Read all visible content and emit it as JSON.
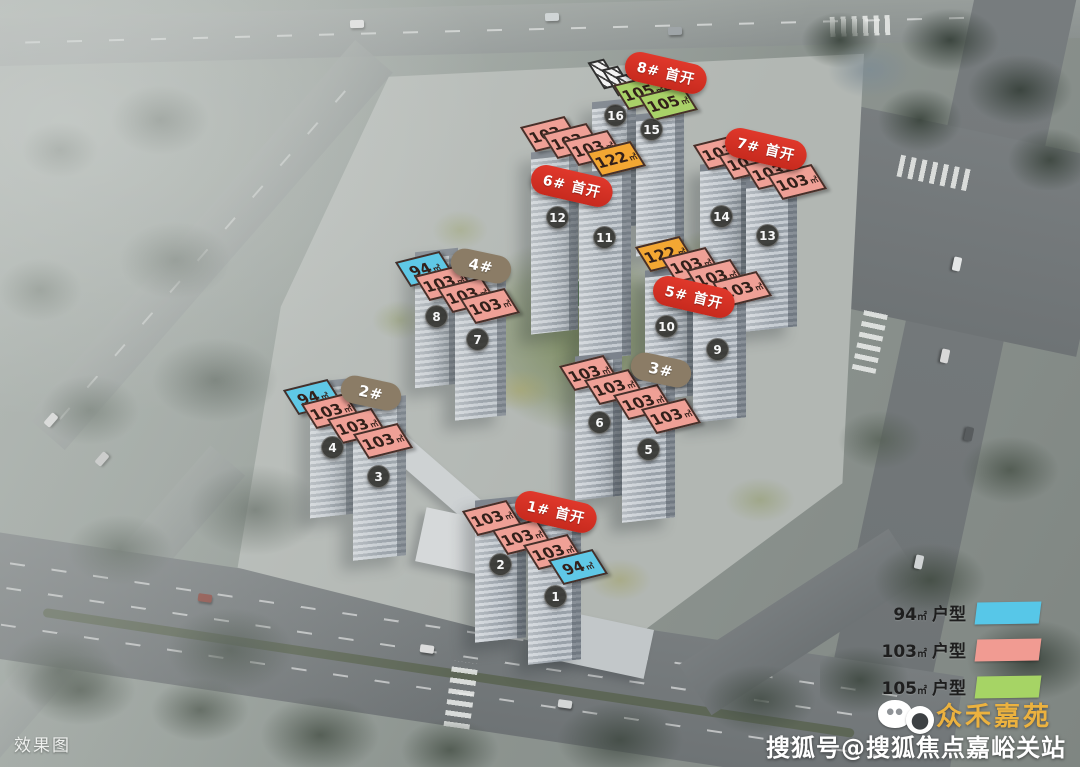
{
  "scene": {
    "type_label": "效果图",
    "watermark": {
      "brand": "众禾嘉苑",
      "source": "搜狐号@搜狐焦点嘉峪关站"
    }
  },
  "colors": {
    "badge_red": "#e0382b",
    "badge_brown": "#8b7c66",
    "tag_94": "#5fc8e6",
    "tag_103": "#efa096",
    "tag_105": "#a9d168",
    "tag_122": "#f3a733",
    "building_circle": "#32322e"
  },
  "legend": {
    "items": [
      {
        "area": "94",
        "unit": "㎡",
        "label": "户型",
        "color": "#57c7e8"
      },
      {
        "area": "103",
        "unit": "㎡",
        "label": "户型",
        "color": "#f19b92"
      },
      {
        "area": "105",
        "unit": "㎡",
        "label": "户型",
        "color": "#a6d465"
      }
    ]
  },
  "badges": [
    {
      "text": "8# 首开",
      "style": "red",
      "x": 666,
      "y": 73,
      "rot": 13
    },
    {
      "text": "7# 首开",
      "style": "red",
      "x": 766,
      "y": 149,
      "rot": 13
    },
    {
      "text": "6# 首开",
      "style": "red",
      "x": 572,
      "y": 186,
      "rot": 13
    },
    {
      "text": "5# 首开",
      "style": "red",
      "x": 694,
      "y": 297,
      "rot": 13
    },
    {
      "text": "1# 首开",
      "style": "red",
      "x": 556,
      "y": 512,
      "rot": 13
    },
    {
      "text": "4#",
      "style": "brown",
      "x": 481,
      "y": 266,
      "rot": 12
    },
    {
      "text": "2#",
      "style": "brown",
      "x": 371,
      "y": 393,
      "rot": 12
    },
    {
      "text": "3#",
      "style": "brown",
      "x": 661,
      "y": 370,
      "rot": 12
    }
  ],
  "unit_tags": [
    {
      "group": "8#",
      "area": "105",
      "unit": "㎡",
      "type": "105",
      "x": 643,
      "y": 92
    },
    {
      "group": "8#",
      "area": "105",
      "unit": "㎡",
      "type": "105",
      "x": 668,
      "y": 103
    },
    {
      "group": "6#",
      "area": "103",
      "unit": "㎡",
      "type": "103",
      "x": 550,
      "y": 134
    },
    {
      "group": "6#",
      "area": "103",
      "unit": "㎡",
      "type": "103",
      "x": 572,
      "y": 141
    },
    {
      "group": "6#",
      "area": "103",
      "unit": "㎡",
      "type": "103",
      "x": 593,
      "y": 148
    },
    {
      "group": "6#",
      "area": "122",
      "unit": "㎡",
      "type": "122",
      "x": 616,
      "y": 159
    },
    {
      "group": "7#",
      "area": "103",
      "unit": "㎡",
      "type": "103",
      "x": 723,
      "y": 152
    },
    {
      "group": "7#",
      "area": "103",
      "unit": "㎡",
      "type": "103",
      "x": 748,
      "y": 162
    },
    {
      "group": "7#",
      "area": "103",
      "unit": "㎡",
      "type": "103",
      "x": 773,
      "y": 172
    },
    {
      "group": "7#",
      "area": "103",
      "unit": "㎡",
      "type": "103",
      "x": 797,
      "y": 182
    },
    {
      "group": "5#",
      "area": "122",
      "unit": "㎡",
      "type": "122",
      "x": 665,
      "y": 254
    },
    {
      "group": "5#",
      "area": "103",
      "unit": "㎡",
      "type": "103",
      "x": 691,
      "y": 265
    },
    {
      "group": "5#",
      "area": "103",
      "unit": "㎡",
      "type": "103",
      "x": 716,
      "y": 277
    },
    {
      "group": "5#",
      "area": "103",
      "unit": "㎡",
      "type": "103",
      "x": 742,
      "y": 289
    },
    {
      "group": "4#",
      "area": "94",
      "unit": "㎡",
      "type": "94",
      "x": 425,
      "y": 269
    },
    {
      "group": "4#",
      "area": "103",
      "unit": "㎡",
      "type": "103",
      "x": 444,
      "y": 283
    },
    {
      "group": "4#",
      "area": "103",
      "unit": "㎡",
      "type": "103",
      "x": 467,
      "y": 295
    },
    {
      "group": "4#",
      "area": "103",
      "unit": "㎡",
      "type": "103",
      "x": 490,
      "y": 306
    },
    {
      "group": "2#",
      "area": "94",
      "unit": "㎡",
      "type": "94",
      "x": 313,
      "y": 397
    },
    {
      "group": "2#",
      "area": "103",
      "unit": "㎡",
      "type": "103",
      "x": 331,
      "y": 411
    },
    {
      "group": "2#",
      "area": "103",
      "unit": "㎡",
      "type": "103",
      "x": 357,
      "y": 426
    },
    {
      "group": "2#",
      "area": "103",
      "unit": "㎡",
      "type": "103",
      "x": 383,
      "y": 441
    },
    {
      "group": "3#",
      "area": "103",
      "unit": "㎡",
      "type": "103",
      "x": 589,
      "y": 373
    },
    {
      "group": "3#",
      "area": "103",
      "unit": "㎡",
      "type": "103",
      "x": 614,
      "y": 387
    },
    {
      "group": "3#",
      "area": "103",
      "unit": "㎡",
      "type": "103",
      "x": 643,
      "y": 402
    },
    {
      "group": "3#",
      "area": "103",
      "unit": "㎡",
      "type": "103",
      "x": 671,
      "y": 416
    },
    {
      "group": "1#",
      "area": "103",
      "unit": "㎡",
      "type": "103",
      "x": 492,
      "y": 518
    },
    {
      "group": "1#",
      "area": "103",
      "unit": "㎡",
      "type": "103",
      "x": 522,
      "y": 537
    },
    {
      "group": "1#",
      "area": "103",
      "unit": "㎡",
      "type": "103",
      "x": 553,
      "y": 552
    },
    {
      "group": "1#",
      "area": "94",
      "unit": "㎡",
      "type": "94",
      "x": 578,
      "y": 567
    }
  ],
  "sold_out_hatch": [
    {
      "x": 604,
      "y": 74
    },
    {
      "x": 618,
      "y": 81
    },
    {
      "x": 632,
      "y": 88
    }
  ],
  "buildings": [
    {
      "num": "1",
      "x": 556,
      "y": 597
    },
    {
      "num": "2",
      "x": 501,
      "y": 565
    },
    {
      "num": "3",
      "x": 379,
      "y": 477
    },
    {
      "num": "4",
      "x": 333,
      "y": 448
    },
    {
      "num": "5",
      "x": 649,
      "y": 450
    },
    {
      "num": "6",
      "x": 600,
      "y": 423
    },
    {
      "num": "7",
      "x": 478,
      "y": 340
    },
    {
      "num": "8",
      "x": 437,
      "y": 317
    },
    {
      "num": "9",
      "x": 718,
      "y": 350
    },
    {
      "num": "10",
      "x": 667,
      "y": 327
    },
    {
      "num": "11",
      "x": 605,
      "y": 238
    },
    {
      "num": "12",
      "x": 558,
      "y": 218
    },
    {
      "num": "13",
      "x": 768,
      "y": 236
    },
    {
      "num": "14",
      "x": 722,
      "y": 217
    },
    {
      "num": "15",
      "x": 652,
      "y": 130
    },
    {
      "num": "16",
      "x": 616,
      "y": 116
    }
  ]
}
